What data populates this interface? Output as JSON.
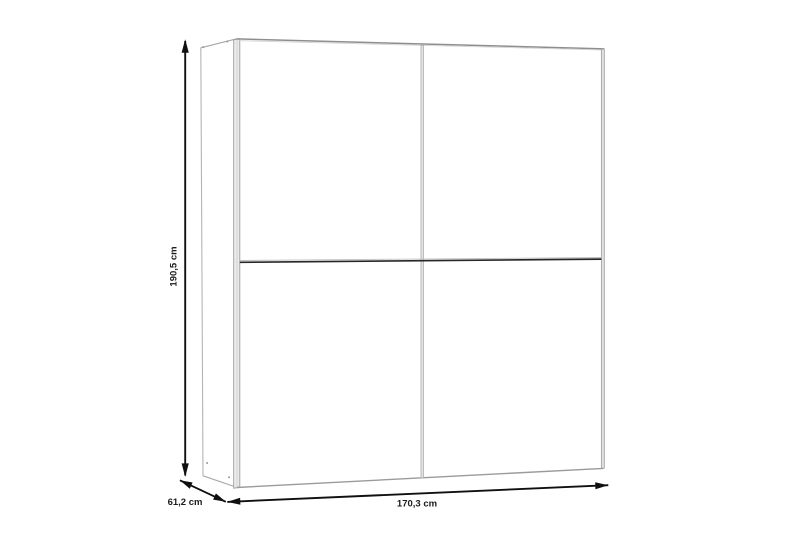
{
  "diagram": {
    "kind": "wardrobe dimension drawing",
    "dimension_labels": {
      "height": "190,5 cm",
      "depth": "61,2 cm",
      "width": "170,3 cm"
    },
    "dimensions_cm": {
      "height": 190.5,
      "depth": 61.2,
      "width": 170.3
    },
    "colors": {
      "background": "#ffffff",
      "furniture_outline": "#9a9a9a",
      "edge_fill": "#e9e9e9",
      "groove_line": "#272727",
      "dimension_arrow": "#101010",
      "label_text": "#1b1b1b"
    }
  }
}
